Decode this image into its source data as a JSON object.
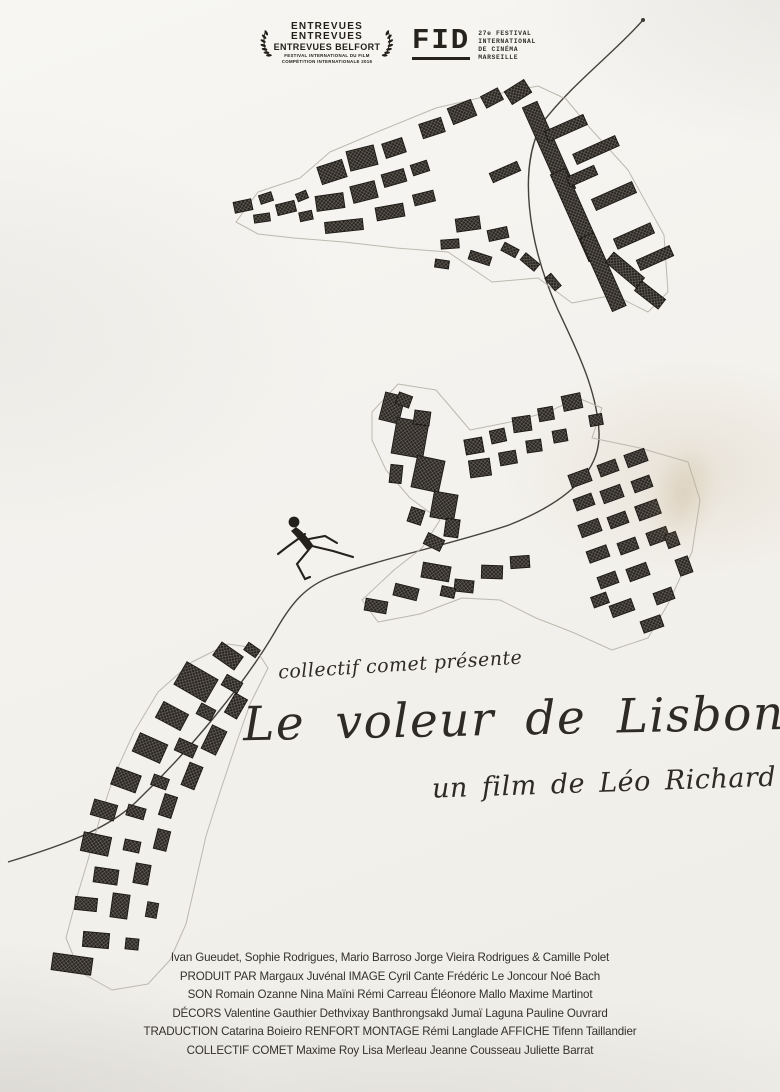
{
  "poster": {
    "badges": {
      "entrevues": {
        "line1": "ENTREVUES",
        "line2": "ENTREVUES",
        "line3": "ENTREVUES BELFORT",
        "sub1": "FESTIVAL INTERNATIONAL DU FILM",
        "sub2": "COMPÉTITION INTERNATIONALE 2016"
      },
      "fid": {
        "acronym": "FID",
        "lines": [
          "27e FESTIVAL",
          "INTERNATIONAL",
          "DE CINÉMA",
          "MARSEILLE"
        ]
      }
    },
    "presented_by": "collectif comet présente",
    "title": "Le voleur de Lisbonne",
    "byline": "un film de Léo Richard",
    "credits": [
      "Ivan Gueudet, Sophie Rodrigues, Mario Barroso Jorge Vieira Rodrigues & Camille Polet",
      "PRODUIT PAR Margaux Juvénal IMAGE Cyril Cante Frédéric Le Joncour Noé Bach",
      "SON Romain Ozanne Nina Maïni Rémi Carreau Éléonore Mallo Maxime Martinot",
      "DÉCORS Valentine Gauthier Dethvixay Banthrongsakd Jumaï Laguna Pauline Ouvrard",
      "TRADUCTION Catarina Boieiro  RENFORT  MONTAGE Rémi Langlade AFFICHE Tifenn Taillandier",
      "COLLECTIF COMET Maxime Roy Lisa Merleau Jeanne Cousseau Juliette Barrat"
    ],
    "colors": {
      "ink": "#26231e",
      "paper": "#f3f1ec",
      "map_outline": "#b7b3a9",
      "path_line": "#45423c"
    },
    "drawings": {
      "top": "town-map-top",
      "middle": "town-map-middle",
      "bottom": "town-map-bottom",
      "path": "winding-road-line",
      "figure": "running-man-drawing"
    }
  }
}
